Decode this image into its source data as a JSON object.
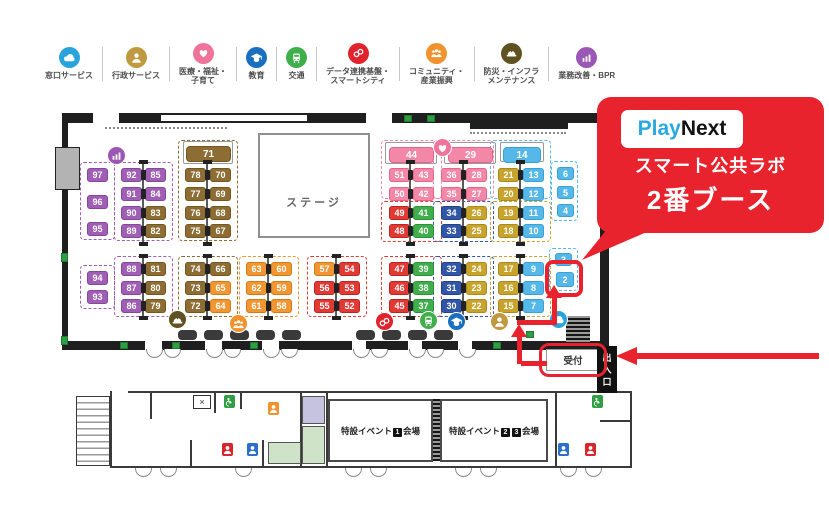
{
  "accent": "#e8232e",
  "legend": {
    "items": [
      {
        "l1": "窓口サービス",
        "l2": "",
        "icon": "cloud",
        "color": "#29a3dc"
      },
      {
        "l1": "行政サービス",
        "l2": "",
        "icon": "person",
        "color": "#c09a40"
      },
      {
        "l1": "医療・福祉・",
        "l2": "子育て",
        "icon": "heart",
        "color": "#f0739c"
      },
      {
        "l1": "教育",
        "l2": "",
        "icon": "edu",
        "color": "#1b6fc0"
      },
      {
        "l1": "交通",
        "l2": "",
        "icon": "train",
        "color": "#3fae4b"
      },
      {
        "l1": "データ連携基盤・",
        "l2": "スマートシティ",
        "icon": "link",
        "color": "#e0232d"
      },
      {
        "l1": "コミュニティ・",
        "l2": "産業振興",
        "icon": "community",
        "color": "#f0922e"
      },
      {
        "l1": "防災・インフラ",
        "l2": "メンテナンス",
        "icon": "bousai",
        "color": "#5f5120"
      },
      {
        "l1": "業務改善・BPR",
        "l2": "",
        "icon": "bpr",
        "color": "#9c57b5"
      }
    ]
  },
  "callout": {
    "logo_play": "Play",
    "logo_next": "Next",
    "logo_play_color": "#2aa9e1",
    "line1": "スマート公共ラボ",
    "line2": "2番ブース"
  },
  "map": {
    "stage_label": "ステージ",
    "reception_label": "受付",
    "entrance_label": "出入口",
    "palette": {
      "purple": {
        "bg": "#a05fb4",
        "bd": "#85479c"
      },
      "brown": {
        "bg": "#8d6d34",
        "bd": "#74571f"
      },
      "orange": {
        "bg": "#f09633",
        "bd": "#d47c14"
      },
      "red": {
        "bg": "#e03a34",
        "bd": "#bd2420"
      },
      "pink": {
        "bg": "#f287a8",
        "bd": "#e4648c"
      },
      "green": {
        "bg": "#3fae4b",
        "bd": "#2d933a"
      },
      "navy": {
        "bg": "#3156a8",
        "bd": "#23418c"
      },
      "gold": {
        "bg": "#c8a42e",
        "bd": "#a98a1c"
      },
      "sky": {
        "bg": "#55b8e8",
        "bd": "#38a2d6"
      }
    },
    "booths": [
      [
        "97",
        "purple",
        87,
        168
      ],
      [
        "96",
        "purple",
        87,
        195
      ],
      [
        "95",
        "purple",
        87,
        222
      ],
      [
        "94",
        "purple",
        87,
        271
      ],
      [
        "93",
        "purple",
        87,
        290
      ],
      [
        "92",
        "purple",
        121,
        168
      ],
      [
        "85",
        "purple",
        145,
        168
      ],
      [
        "91",
        "purple",
        121,
        187
      ],
      [
        "84",
        "purple",
        145,
        187
      ],
      [
        "90",
        "purple",
        121,
        206
      ],
      [
        "83",
        "brown",
        145,
        206
      ],
      [
        "89",
        "purple",
        121,
        224
      ],
      [
        "82",
        "brown",
        145,
        224
      ],
      [
        "88",
        "purple",
        121,
        262
      ],
      [
        "81",
        "brown",
        145,
        262
      ],
      [
        "87",
        "purple",
        121,
        281
      ],
      [
        "80",
        "brown",
        145,
        281
      ],
      [
        "86",
        "purple",
        121,
        299
      ],
      [
        "79",
        "brown",
        145,
        299
      ],
      [
        "71",
        "brown",
        186,
        146,
        45,
        16
      ],
      [
        "78",
        "brown",
        185,
        168
      ],
      [
        "70",
        "brown",
        210,
        168
      ],
      [
        "77",
        "brown",
        185,
        187
      ],
      [
        "69",
        "brown",
        210,
        187
      ],
      [
        "76",
        "brown",
        185,
        206
      ],
      [
        "68",
        "brown",
        210,
        206
      ],
      [
        "75",
        "brown",
        185,
        224
      ],
      [
        "67",
        "brown",
        210,
        224
      ],
      [
        "74",
        "brown",
        185,
        262
      ],
      [
        "66",
        "brown",
        210,
        262
      ],
      [
        "73",
        "brown",
        185,
        281
      ],
      [
        "65",
        "orange",
        210,
        281
      ],
      [
        "72",
        "brown",
        185,
        299
      ],
      [
        "64",
        "orange",
        210,
        299
      ],
      [
        "63",
        "orange",
        246,
        262
      ],
      [
        "60",
        "orange",
        271,
        262
      ],
      [
        "62",
        "orange",
        246,
        281
      ],
      [
        "59",
        "orange",
        271,
        281
      ],
      [
        "61",
        "orange",
        246,
        299
      ],
      [
        "58",
        "orange",
        271,
        299
      ],
      [
        "57",
        "orange",
        314,
        262
      ],
      [
        "54",
        "red",
        339,
        262
      ],
      [
        "56",
        "red",
        314,
        281
      ],
      [
        "53",
        "red",
        339,
        281
      ],
      [
        "55",
        "red",
        314,
        299
      ],
      [
        "52",
        "red",
        339,
        299
      ],
      [
        "44",
        "pink",
        389,
        147,
        45,
        16
      ],
      [
        "51",
        "pink",
        389,
        168
      ],
      [
        "43",
        "pink",
        413,
        168
      ],
      [
        "50",
        "pink",
        389,
        187
      ],
      [
        "42",
        "pink",
        413,
        187
      ],
      [
        "49",
        "red",
        389,
        206
      ],
      [
        "41",
        "green",
        413,
        206
      ],
      [
        "48",
        "red",
        389,
        224
      ],
      [
        "40",
        "green",
        413,
        224
      ],
      [
        "47",
        "red",
        389,
        262
      ],
      [
        "39",
        "green",
        413,
        262
      ],
      [
        "46",
        "red",
        389,
        281
      ],
      [
        "38",
        "green",
        413,
        281
      ],
      [
        "45",
        "red",
        389,
        299
      ],
      [
        "37",
        "green",
        413,
        299
      ],
      [
        "29",
        "pink",
        448,
        147,
        45,
        16
      ],
      [
        "36",
        "pink",
        441,
        168
      ],
      [
        "28",
        "pink",
        466,
        168
      ],
      [
        "35",
        "pink",
        441,
        187
      ],
      [
        "27",
        "pink",
        466,
        187
      ],
      [
        "34",
        "navy",
        441,
        206
      ],
      [
        "26",
        "gold",
        466,
        206
      ],
      [
        "33",
        "navy",
        441,
        224
      ],
      [
        "25",
        "gold",
        466,
        224
      ],
      [
        "32",
        "navy",
        441,
        262
      ],
      [
        "24",
        "gold",
        466,
        262
      ],
      [
        "31",
        "navy",
        441,
        281
      ],
      [
        "23",
        "gold",
        466,
        281
      ],
      [
        "30",
        "navy",
        441,
        299
      ],
      [
        "22",
        "gold",
        466,
        299
      ],
      [
        "14",
        "sky",
        503,
        147,
        38,
        16
      ],
      [
        "21",
        "gold",
        498,
        168
      ],
      [
        "13",
        "sky",
        523,
        168
      ],
      [
        "20",
        "gold",
        498,
        187
      ],
      [
        "12",
        "sky",
        523,
        187
      ],
      [
        "19",
        "gold",
        498,
        206
      ],
      [
        "11",
        "sky",
        523,
        206
      ],
      [
        "18",
        "gold",
        498,
        224
      ],
      [
        "10",
        "sky",
        523,
        224
      ],
      [
        "17",
        "gold",
        498,
        262
      ],
      [
        "9",
        "sky",
        523,
        262
      ],
      [
        "16",
        "gold",
        498,
        281
      ],
      [
        "8",
        "sky",
        523,
        281
      ],
      [
        "15",
        "gold",
        498,
        299
      ],
      [
        "7",
        "sky",
        523,
        299
      ],
      [
        "6",
        "sky",
        557,
        167,
        17,
        13
      ],
      [
        "5",
        "sky",
        557,
        186,
        17,
        13
      ],
      [
        "4",
        "sky",
        557,
        204,
        17,
        13
      ],
      [
        "3",
        "sky",
        555,
        253,
        17,
        13
      ],
      [
        "2",
        "sky",
        556,
        272,
        18,
        15
      ]
    ],
    "dashes": [
      [
        "purple",
        80,
        162,
        35,
        78
      ],
      [
        "purple",
        80,
        265,
        35,
        44
      ],
      [
        "purple",
        114,
        162,
        59,
        79
      ],
      [
        "purple",
        114,
        256,
        59,
        61
      ],
      [
        "brown",
        178,
        140,
        60,
        101
      ],
      [
        "brown",
        178,
        256,
        60,
        61
      ],
      [
        "orange",
        239,
        256,
        60,
        61
      ],
      [
        "red",
        307,
        256,
        60,
        61
      ],
      [
        "pink",
        381,
        140,
        61,
        59
      ],
      [
        "red",
        381,
        201,
        61,
        41
      ],
      [
        "red",
        381,
        256,
        61,
        61
      ],
      [
        "pink",
        433,
        140,
        61,
        59
      ],
      [
        "navy",
        433,
        201,
        61,
        41
      ],
      [
        "navy",
        433,
        256,
        61,
        61
      ],
      [
        "sky",
        490,
        140,
        61,
        59
      ],
      [
        "gold",
        490,
        201,
        61,
        41
      ],
      [
        "gold",
        490,
        256,
        61,
        61
      ],
      [
        "sky",
        551,
        161,
        27,
        60
      ],
      [
        "sky",
        549,
        248,
        29,
        43
      ]
    ],
    "pair_groups": [
      {
        "mid": 143,
        "top": [
          168,
          187,
          206,
          224
        ],
        "bot": [
          262,
          281,
          299
        ]
      },
      {
        "mid": 207,
        "top": [
          168,
          187,
          206,
          224
        ],
        "bot": [
          262,
          281,
          299
        ]
      },
      {
        "mid": 268,
        "top": [],
        "bot": [
          262,
          281,
          299
        ]
      },
      {
        "mid": 336,
        "top": [],
        "bot": [
          262,
          281,
          299
        ]
      },
      {
        "mid": 410,
        "top": [
          168,
          187,
          206,
          224
        ],
        "bot": [
          262,
          281,
          299
        ]
      },
      {
        "mid": 463,
        "top": [
          168,
          187,
          206,
          224
        ],
        "bot": [
          262,
          281,
          299
        ]
      },
      {
        "mid": 520,
        "top": [
          168,
          187,
          206,
          224
        ],
        "bot": [
          262,
          281,
          299
        ]
      }
    ],
    "icons": [
      [
        "bpr",
        "#9c57b5",
        115,
        154
      ],
      [
        "heart",
        "#f0739c",
        441,
        146
      ],
      [
        "link",
        "#e0232d",
        383,
        320
      ],
      [
        "train",
        "#3fae4b",
        427,
        319
      ],
      [
        "edu",
        "#1b6fc0",
        455,
        320
      ],
      [
        "person",
        "#c09a40",
        498,
        320
      ],
      [
        "bousai",
        "#5f5120",
        176,
        318
      ],
      [
        "community",
        "#f0922e",
        237,
        322
      ],
      [
        "cloud",
        "#29a3dc",
        557,
        318
      ]
    ],
    "badges": [
      [
        "person",
        "#d8262c",
        222,
        443
      ],
      [
        "person",
        "#2a6fc9",
        247,
        443
      ],
      [
        "acc",
        "#2f9e44",
        224,
        395
      ],
      [
        "person",
        "#f0922e",
        268,
        402
      ],
      [
        "person",
        "#2a6fc9",
        558,
        443
      ],
      [
        "person",
        "#d8262c",
        585,
        443
      ],
      [
        "acc",
        "#2f9e44",
        592,
        395
      ]
    ],
    "shapes": [
      [
        "wall",
        62,
        113,
        548,
        10
      ],
      [
        "gap",
        93,
        113,
        26,
        10
      ],
      [
        "gap",
        366,
        113,
        26,
        10
      ],
      [
        "inset",
        160,
        114,
        148,
        8
      ],
      [
        "wall",
        470,
        122,
        98,
        7
      ],
      [
        "dot",
        105,
        127,
        122,
        3
      ],
      [
        "dot",
        470,
        132,
        96,
        3
      ],
      [
        "wall",
        62,
        113,
        6,
        230
      ],
      [
        "graydoor",
        55,
        147,
        25,
        43
      ],
      [
        "wall",
        600,
        113,
        9,
        233
      ],
      [
        "wall",
        62,
        341,
        538,
        9
      ],
      [
        "gap",
        145,
        341,
        17,
        9
      ],
      [
        "gap",
        205,
        341,
        17,
        9
      ],
      [
        "gap",
        262,
        341,
        17,
        9
      ],
      [
        "gap",
        352,
        341,
        14,
        9
      ],
      [
        "gap",
        408,
        341,
        14,
        9
      ],
      [
        "gap",
        458,
        341,
        14,
        9
      ],
      [
        "hatch",
        566,
        316,
        24,
        28
      ],
      [
        "tback",
        183,
        141,
        50,
        23
      ],
      [
        "tback",
        385,
        142,
        52,
        22
      ],
      [
        "tback",
        444,
        142,
        52,
        22
      ],
      [
        "tback",
        500,
        142,
        44,
        20
      ],
      [
        "arc",
        146,
        349,
        17,
        9
      ],
      [
        "arc",
        164,
        349,
        17,
        9
      ],
      [
        "arc",
        206,
        349,
        17,
        9
      ],
      [
        "arc",
        224,
        349,
        17,
        9
      ],
      [
        "arc",
        263,
        349,
        17,
        9
      ],
      [
        "arc",
        281,
        349,
        17,
        9
      ],
      [
        "arc",
        353,
        349,
        17,
        9
      ],
      [
        "arc",
        371,
        349,
        17,
        9
      ],
      [
        "arc",
        409,
        349,
        17,
        9
      ],
      [
        "arc",
        427,
        349,
        17,
        9
      ],
      [
        "arc",
        459,
        349,
        17,
        9
      ],
      [
        "gdoor",
        404,
        115,
        8,
        7
      ],
      [
        "gdoor",
        427,
        115,
        8,
        7
      ],
      [
        "gdoor",
        61,
        253,
        7,
        9
      ],
      [
        "gdoor",
        61,
        336,
        7,
        9
      ],
      [
        "gdoor",
        120,
        342,
        8,
        7
      ],
      [
        "gdoor",
        172,
        342,
        8,
        7
      ],
      [
        "gdoor",
        250,
        342,
        8,
        7
      ],
      [
        "gdoor",
        493,
        342,
        8,
        7
      ],
      [
        "gdoor",
        526,
        331,
        8,
        7
      ],
      [
        "rtable",
        178,
        330,
        19,
        10
      ],
      [
        "rtable",
        204,
        330,
        19,
        10
      ],
      [
        "rtable",
        230,
        330,
        19,
        10
      ],
      [
        "rtable",
        256,
        330,
        19,
        10
      ],
      [
        "rtable",
        282,
        330,
        19,
        10
      ],
      [
        "rtable",
        356,
        330,
        19,
        10
      ],
      [
        "rtable",
        382,
        330,
        19,
        10
      ],
      [
        "rtable",
        408,
        330,
        19,
        10
      ],
      [
        "rtable",
        434,
        330,
        19,
        10
      ],
      [
        "ln",
        128,
        391,
        502,
        2
      ],
      [
        "ln",
        110,
        466,
        522,
        2
      ],
      [
        "ln",
        110,
        391,
        2,
        77
      ],
      [
        "ln",
        630,
        391,
        2,
        77
      ],
      [
        "stairs",
        76,
        396,
        34,
        70
      ],
      [
        "ln",
        150,
        391,
        2,
        28
      ],
      [
        "ln",
        214,
        391,
        2,
        22
      ],
      [
        "ln",
        190,
        440,
        2,
        28
      ],
      [
        "ln",
        240,
        391,
        2,
        18
      ],
      [
        "ln",
        262,
        440,
        2,
        28
      ],
      [
        "ln",
        300,
        391,
        2,
        77
      ],
      [
        "ln",
        326,
        391,
        2,
        77
      ],
      [
        "ln",
        555,
        391,
        2,
        77
      ],
      [
        "ln",
        600,
        420,
        30,
        2
      ],
      [
        "roomlav",
        302,
        396,
        23,
        28
      ],
      [
        "roomgrn",
        302,
        426,
        23,
        38
      ],
      [
        "roomgrn",
        268,
        442,
        33,
        22
      ],
      [
        "hatch",
        433,
        399,
        8,
        62
      ],
      [
        "arc",
        135,
        468,
        17,
        9
      ],
      [
        "arc",
        160,
        468,
        17,
        9
      ],
      [
        "arc",
        235,
        468,
        17,
        9
      ],
      [
        "arc",
        345,
        468,
        17,
        9
      ],
      [
        "arc",
        370,
        468,
        17,
        9
      ],
      [
        "arc",
        455,
        468,
        17,
        9
      ],
      [
        "arc",
        480,
        468,
        17,
        9
      ],
      [
        "arc",
        560,
        468,
        17,
        9
      ],
      [
        "arc",
        585,
        468,
        17,
        9
      ],
      [
        "elev",
        193,
        395,
        18,
        14
      ]
    ]
  },
  "lower": {
    "hall_prefix": "特設イベント",
    "hall_suffix": "会場",
    "hall1_num": "1",
    "hall2_num1": "2",
    "hall2_num2": "3"
  }
}
